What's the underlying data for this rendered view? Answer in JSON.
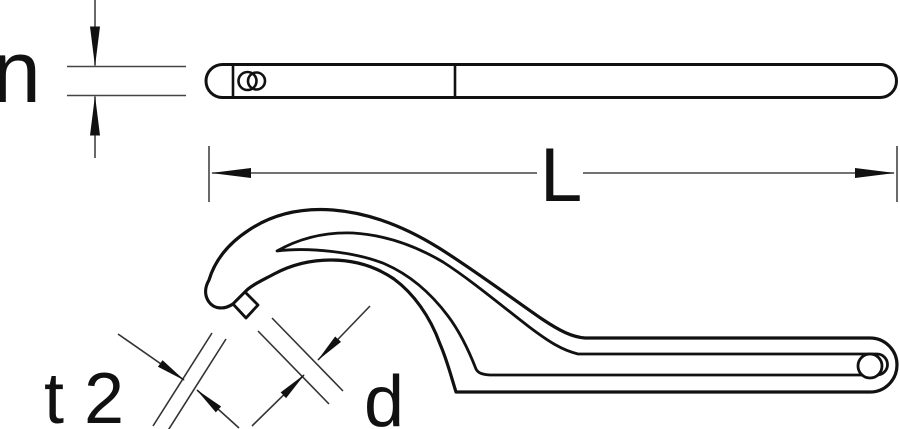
{
  "drawing": {
    "background_color": "#ffffff",
    "line_color": "#111111",
    "thin_line_color": "#444444",
    "labels": {
      "thickness": "n",
      "length": "L",
      "nose_thickness": "t 2",
      "nose_diameter": "d"
    }
  }
}
